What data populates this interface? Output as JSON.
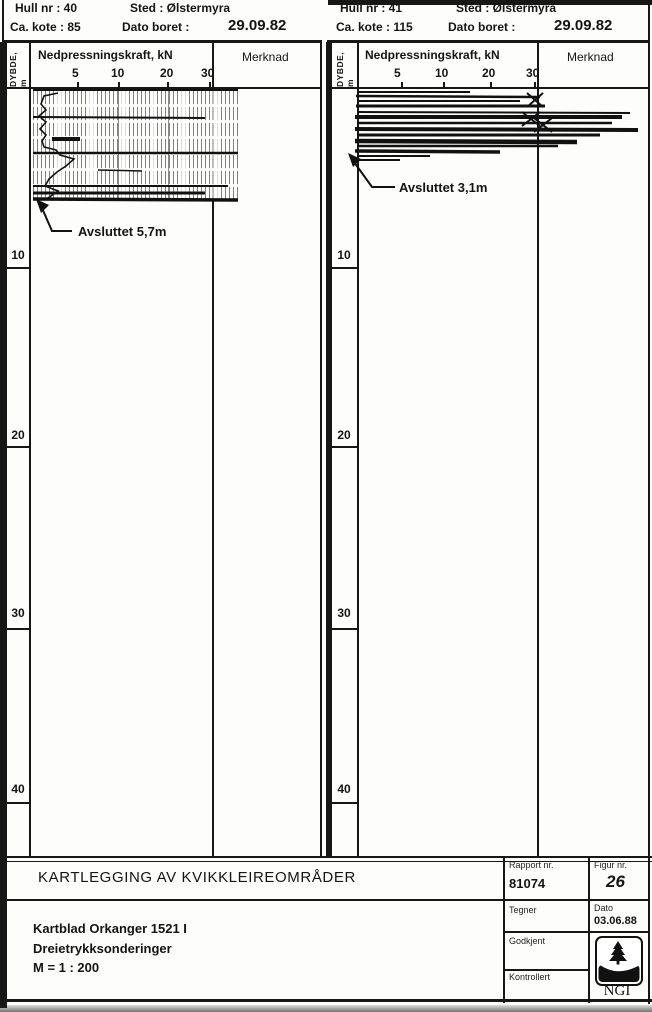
{
  "headers": [
    {
      "hull": "Hull nr : 40",
      "sted": "Sted : Ølstermyra",
      "kote": "Ca. kote : 85",
      "dato_label": "Dato boret :",
      "dato_value": "29.09.82"
    },
    {
      "hull": "Hull nr : 41",
      "sted": "Sted : Ølstermyra",
      "kote": "Ca. kote : 115",
      "dato_label": "Dato boret :",
      "dato_value": "29.09.82"
    }
  ],
  "charts": [
    {
      "depth_axis_label": "DYBDE, m",
      "force_axis_title": "Nedpressningskraft, kN",
      "merknad_label": "Merknad",
      "force_ticks": [
        "5",
        "10",
        "20",
        "30"
      ],
      "depth_ticks": [
        "10",
        "20",
        "30",
        "40"
      ],
      "annotation": "Avsluttet 5,7m"
    },
    {
      "depth_axis_label": "DYBDE, m",
      "force_axis_title": "Nedpressningskraft, kN",
      "merknad_label": "Merknad",
      "force_ticks": [
        "5",
        "10",
        "20",
        "30"
      ],
      "depth_ticks": [
        "10",
        "20",
        "30",
        "40"
      ],
      "annotation": "Avsluttet 3,1m"
    }
  ],
  "title_block": {
    "title": "KARTLEGGING AV KVIKKLEIREOMRÅDER",
    "line1": "Kartblad Orkanger 1521 I",
    "line2": "Dreietrykksonderinger",
    "line3": "M = 1 : 200",
    "rapport_label": "Rapport nr.",
    "rapport_value": "81074",
    "figur_label": "Figur nr.",
    "figur_value": "26",
    "tegner_label": "Tegner",
    "dato_label": "Dato",
    "dato_value": "03.06.88",
    "godkjent_label": "Godkjent",
    "kontrollert_label": "Kontrollert",
    "logo_text": "NGI"
  },
  "chart_data": [
    {
      "type": "line",
      "title": "Hull nr 40 – Dreietrykksondering",
      "xlabel": "Nedpressningskraft, kN",
      "ylabel": "Dybde, m",
      "xlim": [
        0,
        35
      ],
      "ylim": [
        0,
        42.5
      ],
      "x_ticks": [
        5,
        10,
        20,
        30
      ],
      "y_ticks": [
        10,
        20,
        30,
        40
      ],
      "grid": false,
      "series": [
        {
          "name": "Nedpressningskraft",
          "points_depth_m_vs_kN": [
            [
              0,
              1
            ],
            [
              0.5,
              2
            ],
            [
              1,
              1.5
            ],
            [
              1.5,
              2.5
            ],
            [
              2,
              2
            ],
            [
              2.5,
              3
            ],
            [
              3,
              5
            ],
            [
              3.5,
              7
            ],
            [
              4,
              6
            ],
            [
              4.5,
              4
            ],
            [
              5,
              3
            ],
            [
              5.5,
              4
            ],
            [
              5.7,
              3
            ]
          ],
          "note": "Approximate – scanned record largely illegible; dense hatched band spans 0–5.7 m across 0–35 kN"
        }
      ],
      "annotations": [
        "Avsluttet 5,7m"
      ],
      "termination_depth_m": 5.7
    },
    {
      "type": "line",
      "title": "Hull nr 41 – Dreietrykksondering",
      "xlabel": "Nedpressningskraft, kN",
      "ylabel": "Dybde, m",
      "xlim": [
        0,
        35
      ],
      "ylim": [
        0,
        42.5
      ],
      "x_ticks": [
        5,
        10,
        20,
        30
      ],
      "y_ticks": [
        10,
        20,
        30,
        40
      ],
      "grid": false,
      "series": [
        {
          "name": "Nedpressningskraft",
          "points_depth_m_vs_kN": [
            [
              0,
              10
            ],
            [
              0.4,
              20
            ],
            [
              0.8,
              30
            ],
            [
              1.2,
              28
            ],
            [
              1.6,
              32
            ],
            [
              2,
              30
            ],
            [
              2.4,
              26
            ],
            [
              2.8,
              20
            ],
            [
              3.1,
              12
            ]
          ],
          "note": "Approximate – heavy scan smear 0–3.1 m; X marks plotted near 30 kN between 0.3 and 2.2 m"
        }
      ],
      "annotations": [
        "Avsluttet 3,1m"
      ],
      "termination_depth_m": 3.1
    }
  ]
}
